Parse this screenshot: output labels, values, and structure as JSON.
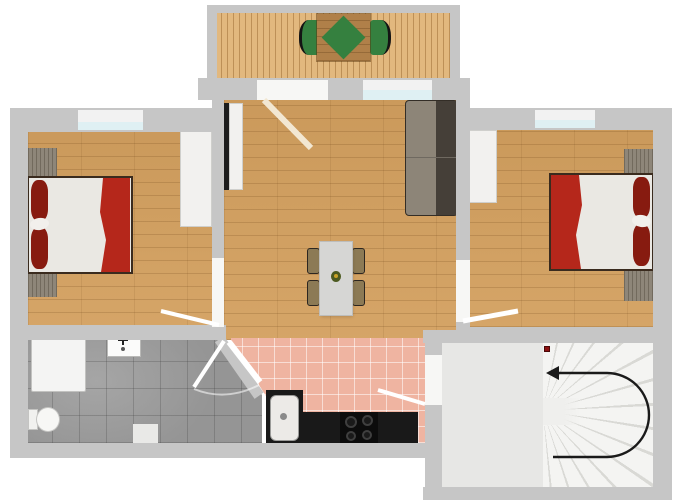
{
  "view": {
    "type": "floor-plan",
    "projection": "2d-top-down",
    "text_labels_visible": "none"
  },
  "colors": {
    "wall": "#c6c6c6",
    "wood": "#d3a05f",
    "deck": "#e2b87e",
    "bathtile": "#9e9e9e",
    "pinktile": "#efb4a1",
    "glass": "#dff0f3",
    "stair_floor": "#e7e7e5",
    "stair_step": "#f4f4f2",
    "stair_line": "#d9d9d5",
    "bed_duvet": "#eae8e3",
    "blanket_red": "#b5271b",
    "pillow_red": "#871b10",
    "sofa_seat": "#8d8578",
    "sofa_back": "#453f38",
    "chair_tan": "#8c7a55",
    "dining_table": "#d6d6d4",
    "counter_black": "#191919",
    "outdoor_green": "#35803f",
    "door_leaf": "#ffffff",
    "balcony_door_leaf": "#f2e7d2",
    "arrow": "#1a1a1a",
    "stair_dot": "#8c1111"
  },
  "rooms": [
    {
      "name": "balcony",
      "floor": "wood-deck",
      "furniture": [
        "outdoor-table",
        "green-table-cover",
        "outdoor-chair-left",
        "outdoor-chair-right"
      ]
    },
    {
      "name": "bedroom-left",
      "floor": "wood",
      "furniture": [
        "double-bed",
        "pillows",
        "red-blanket",
        "nightstand-top",
        "nightstand-bottom",
        "wardrobe"
      ],
      "openings": [
        "window-top",
        "door-to-living-room"
      ]
    },
    {
      "name": "living-room",
      "floor": "wood",
      "furniture": [
        "sofa",
        "tv",
        "tv-console",
        "dining-table",
        "4-dining-chairs",
        "table-centerpiece"
      ],
      "openings": [
        "balcony-door",
        "window-top"
      ]
    },
    {
      "name": "bedroom-right",
      "floor": "wood",
      "furniture": [
        "double-bed",
        "pillows",
        "red-blanket",
        "nightstand-top",
        "nightstand-bottom",
        "wardrobe"
      ],
      "openings": [
        "window-top",
        "door-to-living-room"
      ]
    },
    {
      "name": "bathroom",
      "floor": "gray-tile",
      "furniture": [
        "shower",
        "sink",
        "toilet",
        "mat"
      ],
      "openings": [
        "diagonal-corner-door"
      ]
    },
    {
      "name": "kitchen",
      "floor": "pink-tile",
      "furniture": [
        "sink-cabinet",
        "counter",
        "stove-4-burners"
      ],
      "openings": [
        "open-to-living-room",
        "door-to-staircase"
      ]
    },
    {
      "name": "staircase",
      "floor": "light-gray",
      "features": [
        "winder-stairs-fan",
        "u-turn-arrow-pointing-left",
        "red-start-dot"
      ]
    }
  ],
  "door_count": 5,
  "window_count": 3,
  "stair_arrow": {
    "shape": "U-turn",
    "opens": "left",
    "head_direction": "left"
  }
}
